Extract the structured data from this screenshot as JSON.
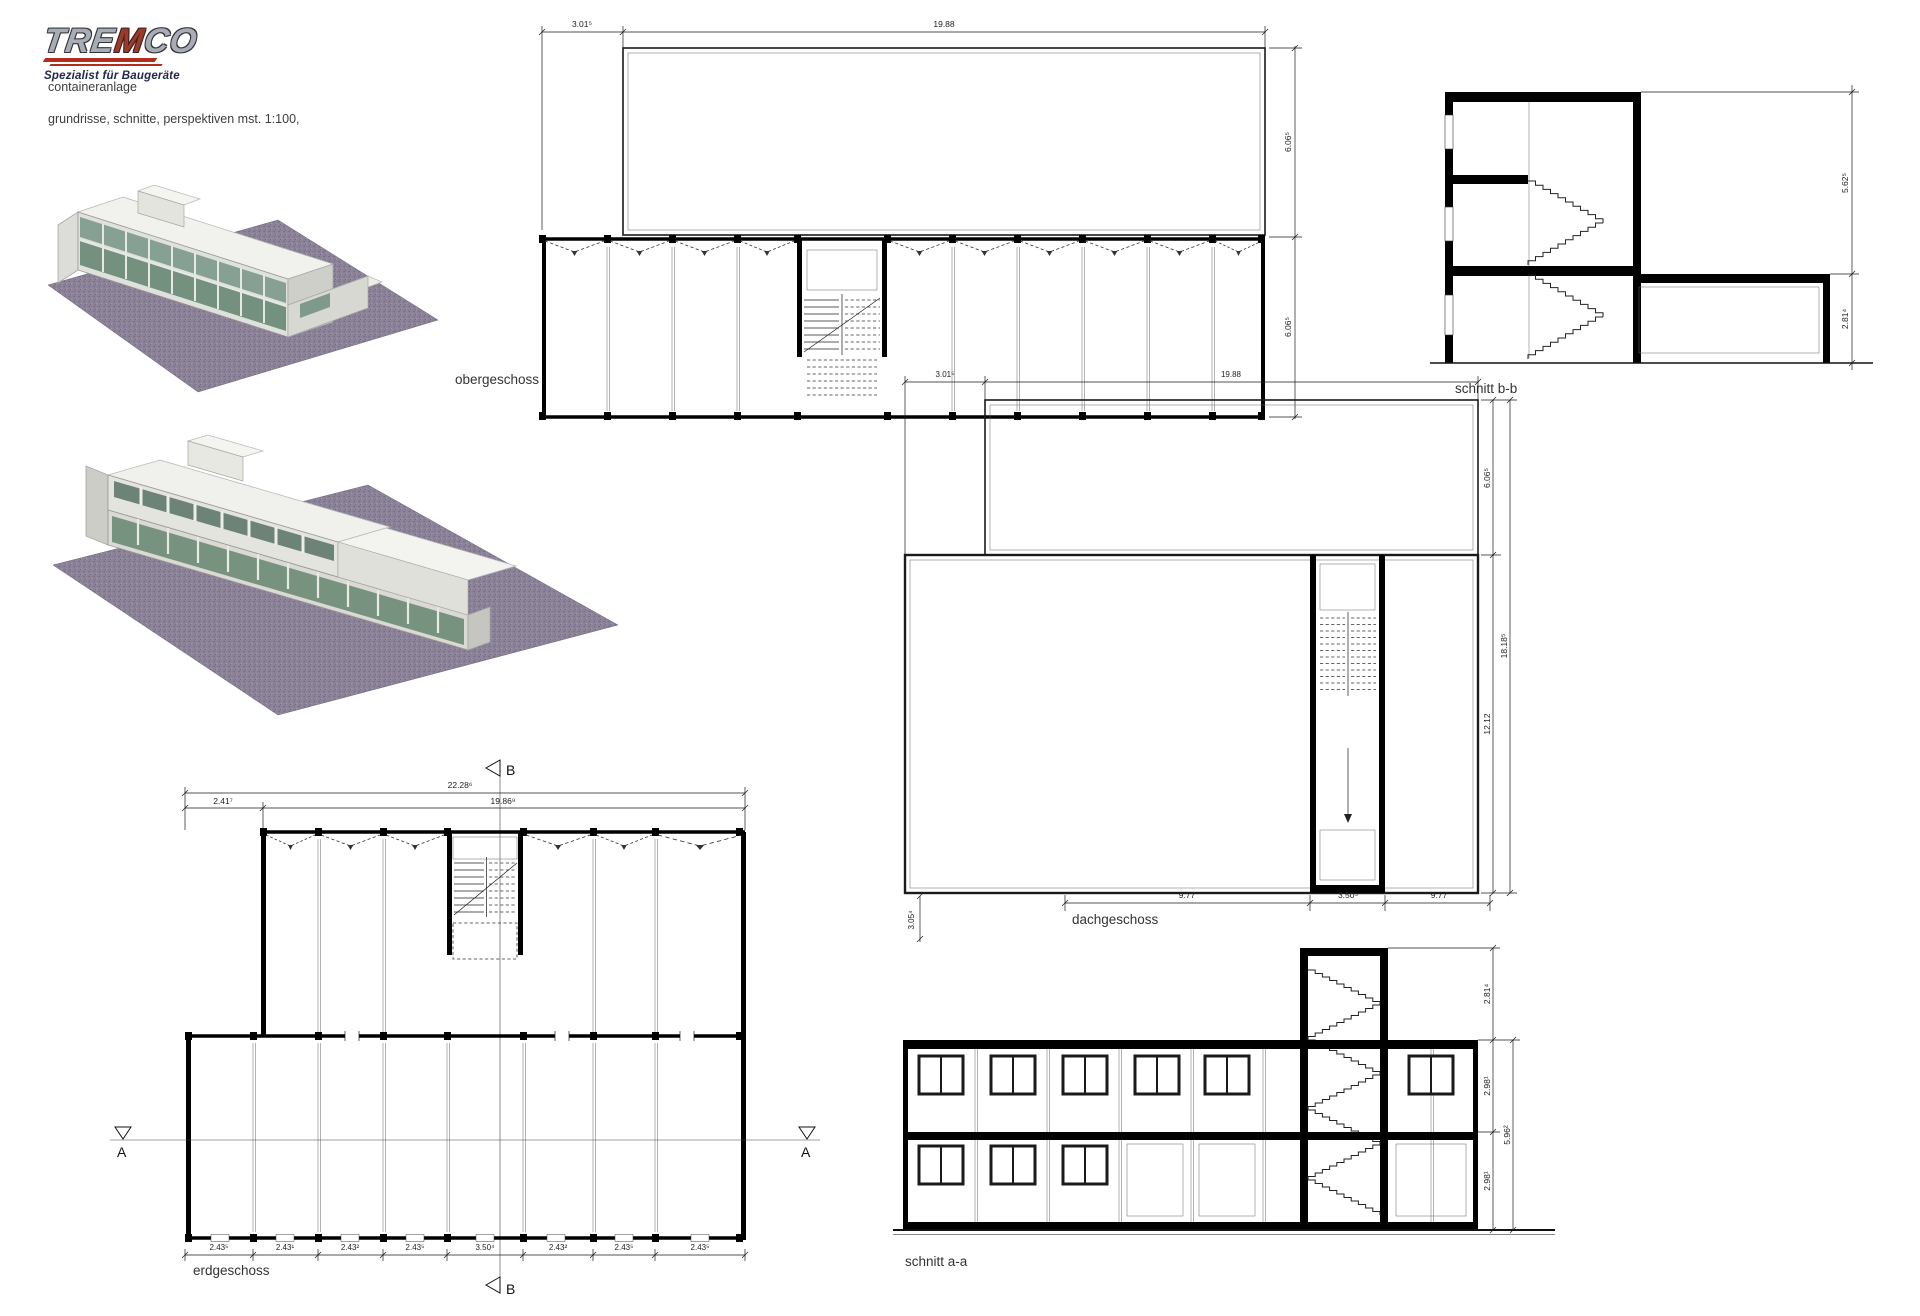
{
  "branding": {
    "logo_part1": "TRE",
    "logo_part2": "M",
    "logo_part3": "CO",
    "tagline": "Spezialist für Baugeräte",
    "project_title": "containeranlage",
    "subtitle": "grundrisse, schnitte, perspektiven mst. 1:100,",
    "accent_red": "#b22d1d"
  },
  "plans": {
    "obergeschoss": {
      "label": "obergeschoss",
      "dim_top": [
        "3.01⁵",
        "19.88"
      ],
      "dim_right": [
        "6.06⁵",
        "6.06⁵"
      ]
    },
    "dachgeschoss": {
      "label": "dachgeschoss",
      "dim_top": [
        "3.01⁵",
        "19.88"
      ],
      "dim_right": [
        "6.06⁵",
        "12.12"
      ],
      "dim_right_total": "18.18⁵",
      "dim_bottom": [
        "9.77",
        "3.50⁵",
        "9.77"
      ],
      "dim_left": "3.05⁴"
    },
    "erdgeschoss": {
      "label": "erdgeschoss",
      "dim_total": "22.28⁶",
      "dim_row2": [
        "2.41⁷",
        "19.86⁹"
      ],
      "dim_bottom": [
        "2.43⁵",
        "2.43¹",
        "2.43²",
        "2.43⁵",
        "3.50⁴",
        "2.43²",
        "2.43⁵",
        "2.43⁵"
      ],
      "section_marker_a": "A",
      "section_marker_b": "B"
    }
  },
  "sections": {
    "schnitt_bb": {
      "label": "schnitt b-b",
      "dim_right": [
        "5.62⁵",
        "2.81⁴"
      ]
    },
    "schnitt_aa": {
      "label": "schnitt a-a",
      "dim_right": [
        "2.81⁴",
        "2.98¹",
        "2.98¹"
      ],
      "dim_right_total": "5.96²"
    }
  }
}
